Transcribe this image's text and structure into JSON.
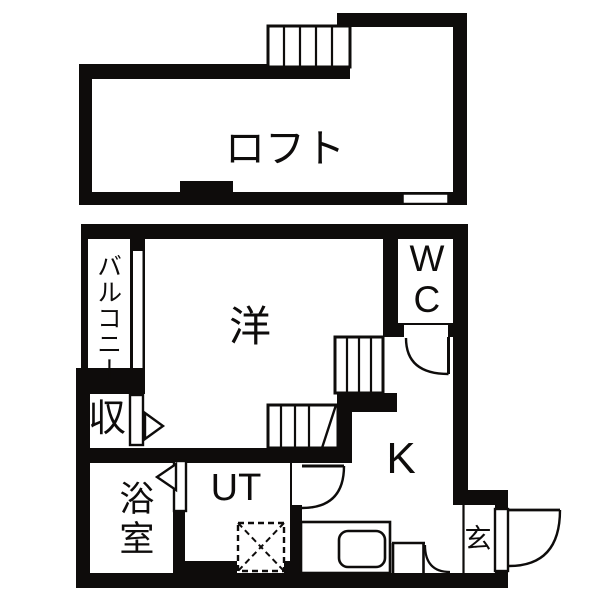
{
  "plan": {
    "type": "japanese-apartment-floor-plan",
    "wall_color": "#0e0c0b",
    "floor_color": "#ffffff",
    "rooms": {
      "loft": {
        "label": "ロフト"
      },
      "western": {
        "label": "洋"
      },
      "balcony": {
        "label": "バルコニー"
      },
      "storage": {
        "label": "収"
      },
      "bathroom": {
        "label": "浴室"
      },
      "utility": {
        "label": "UT"
      },
      "kitchen": {
        "label": "K"
      },
      "toilet": {
        "label": "WC"
      },
      "entrance": {
        "label": "玄"
      }
    }
  }
}
